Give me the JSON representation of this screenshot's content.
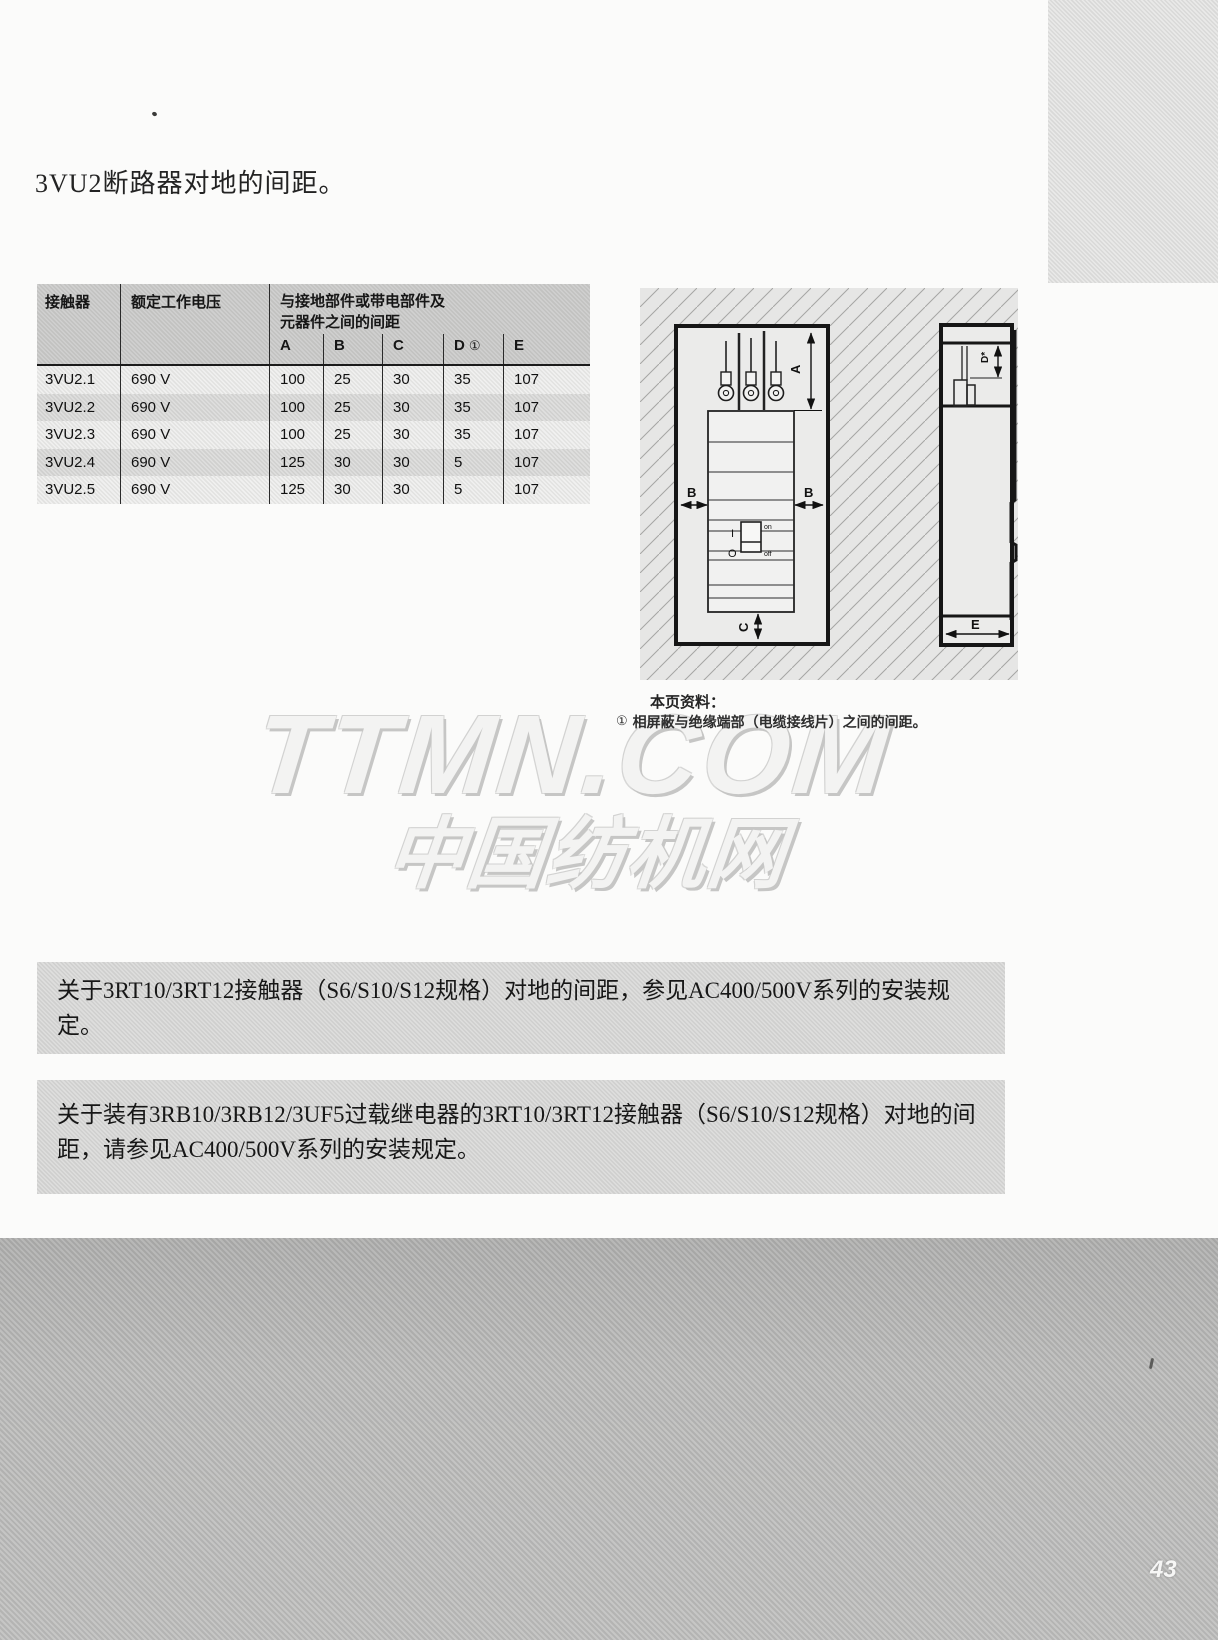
{
  "page": {
    "title": "3VU2断路器对地的间距。",
    "page_number": "43"
  },
  "table": {
    "headers": {
      "contactor": "接触器",
      "voltage": "额定工作电压",
      "clearance_line1": "与接地部件或带电部件及",
      "clearance_line2": "元器件之间的间距",
      "cols": [
        "A",
        "B",
        "C",
        "D",
        "E"
      ],
      "d_footnote_mark": "①"
    },
    "rows": [
      {
        "model": "3VU2.1",
        "voltage": "690 V",
        "a": "100",
        "b": "25",
        "c": "30",
        "d": "35",
        "e": "107"
      },
      {
        "model": "3VU2.2",
        "voltage": "690 V",
        "a": "100",
        "b": "25",
        "c": "30",
        "d": "35",
        "e": "107"
      },
      {
        "model": "3VU2.3",
        "voltage": "690 V",
        "a": "100",
        "b": "25",
        "c": "30",
        "d": "35",
        "e": "107"
      },
      {
        "model": "3VU2.4",
        "voltage": "690 V",
        "a": "125",
        "b": "30",
        "c": "30",
        "d": "5",
        "e": "107"
      },
      {
        "model": "3VU2.5",
        "voltage": "690 V",
        "a": "125",
        "b": "30",
        "c": "30",
        "d": "5",
        "e": "107"
      }
    ]
  },
  "diagram": {
    "front": {
      "dim_a": "A",
      "dim_b_left": "B",
      "dim_b_right": "B",
      "dim_c": "C",
      "toggle_on": "I",
      "toggle_off": "O",
      "label_on": "on",
      "label_off": "off"
    },
    "side": {
      "dim_d": "D*",
      "dim_e": "E"
    }
  },
  "note": {
    "heading": "本页资料：",
    "footnote_mark": "①",
    "footnote_text": "相屏蔽与绝缘端部（电缆接线片）之间的间距。"
  },
  "watermark": {
    "line1": "TTMN.COM",
    "line2": "中国纺机网"
  },
  "paragraphs": [
    {
      "text": "关于3RT10/3RT12接触器（S6/S10/S12规格）对地的间距，参见AC400/500V系列的安装规定。"
    },
    {
      "text": "关于装有3RB10/3RB12/3UF5过载继电器的3RT10/3RT12接触器（S6/S10/S12规格）对地的间距，请参见AC400/500V系列的安装规定。"
    }
  ],
  "colors": {
    "table_header_bg": "#cbcbca",
    "table_row_light": "#efefee",
    "table_row_dark": "#dbdbda",
    "paragraph_block_bg": "#dadad9",
    "bottom_band_gray": "#bbbbba",
    "hatch_bg": "#e6e6e5",
    "line_black": "#1b1b1b"
  }
}
